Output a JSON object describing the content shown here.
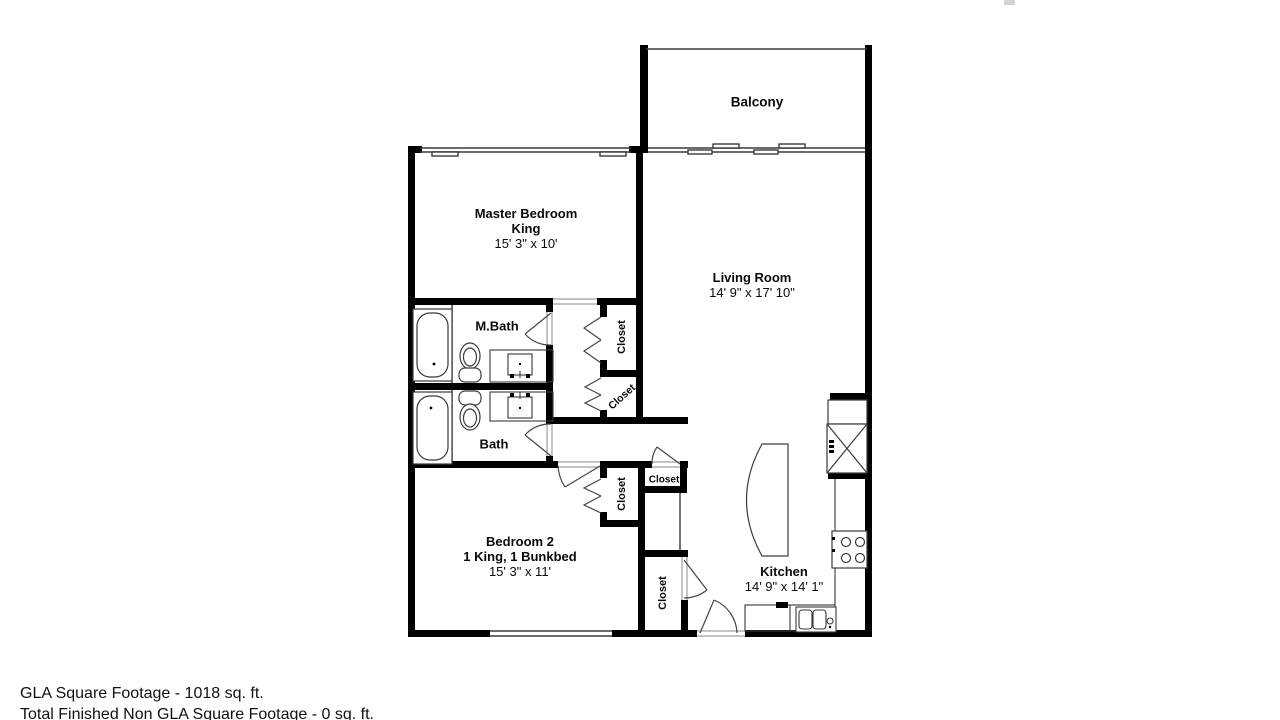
{
  "rooms": {
    "balcony": {
      "name": "Balcony"
    },
    "master_bedroom": {
      "name": "Master Bedroom",
      "bed": "King",
      "dims": "15' 3\" x 10'"
    },
    "living_room": {
      "name": "Living Room",
      "dims": "14' 9\" x 17' 10\""
    },
    "master_bath": {
      "name": "M.Bath"
    },
    "bath": {
      "name": "Bath"
    },
    "bedroom2": {
      "name": "Bedroom 2",
      "bed": "1 King, 1 Bunkbed",
      "dims": "15' 3\" x 11'"
    },
    "kitchen": {
      "name": "Kitchen",
      "dims": "14' 9\" x 14' 1\""
    }
  },
  "closets": {
    "hall_upper": "Closet",
    "hall_lower": "Closet",
    "bedroom2_closet": "Closet",
    "hall_small": "Closet",
    "entry_closet": "Closet"
  },
  "footer": {
    "gla": "GLA Square Footage - 1018 sq. ft.",
    "non_gla": "Total Finished Non GLA Square Footage - 0 sq. ft."
  },
  "colors": {
    "wall": "#000000",
    "line": "#444444",
    "background": "#ffffff"
  }
}
